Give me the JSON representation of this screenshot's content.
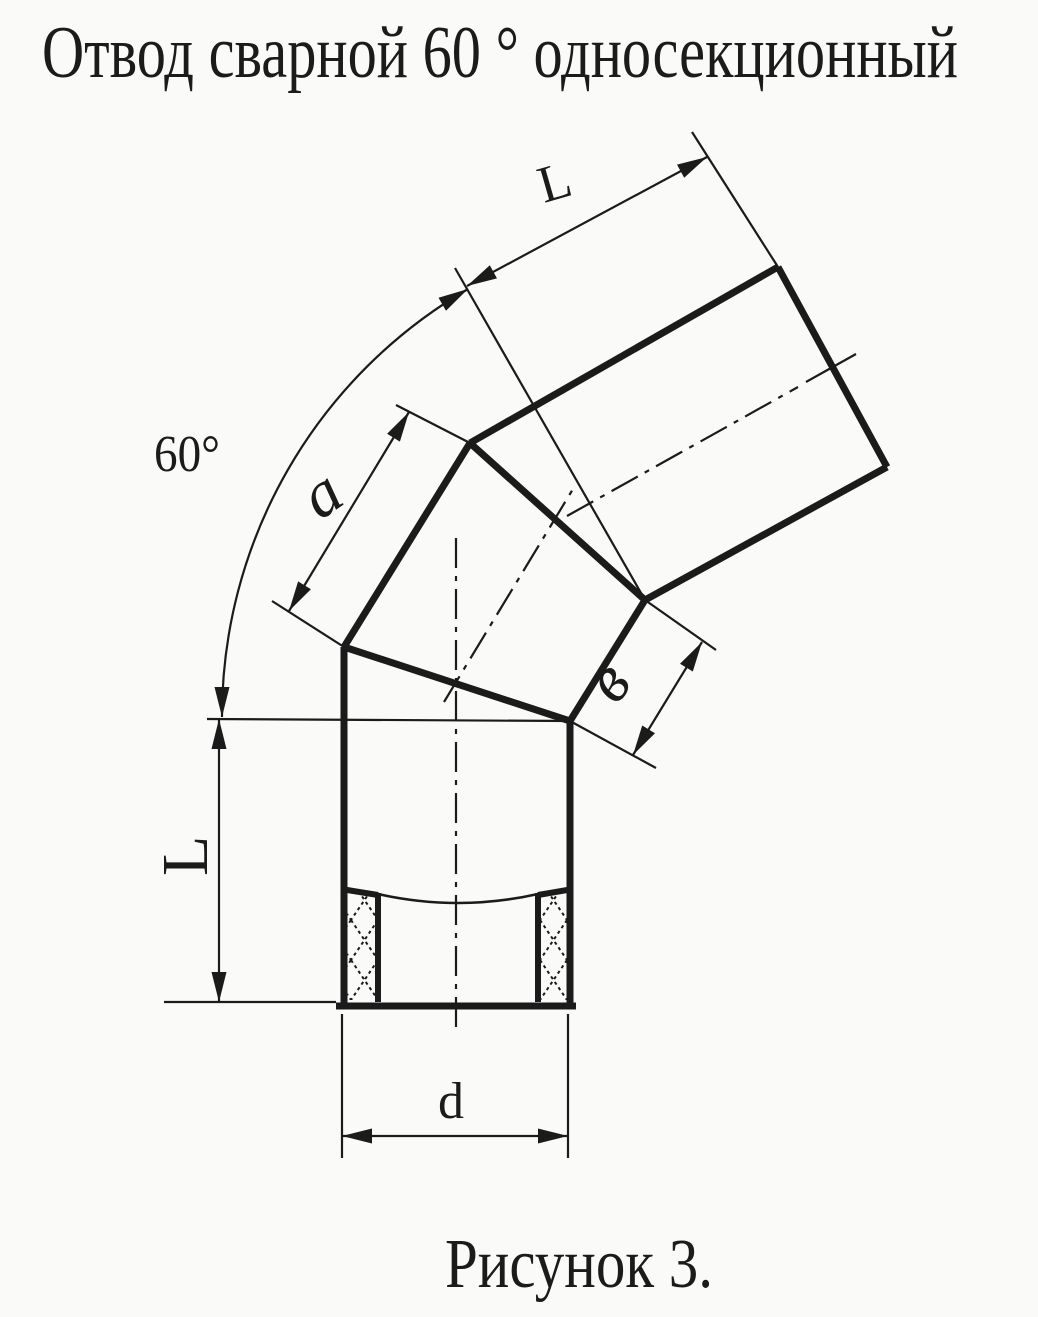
{
  "title": "Отвод сварной 60 ° односекционный",
  "caption": "Рисунок 3.",
  "drawing": {
    "subject": "technical-drawing-welded-pipe-elbow",
    "ink_color": "#1b1b1b",
    "paper_color": "#fafaf8",
    "labels": {
      "bend_angle": "60°",
      "upper_segment_length": "L",
      "lower_segment_length": "L",
      "middle_section_outer_length": "a",
      "middle_section_inner_length": "в",
      "pipe_diameter": "d"
    }
  }
}
